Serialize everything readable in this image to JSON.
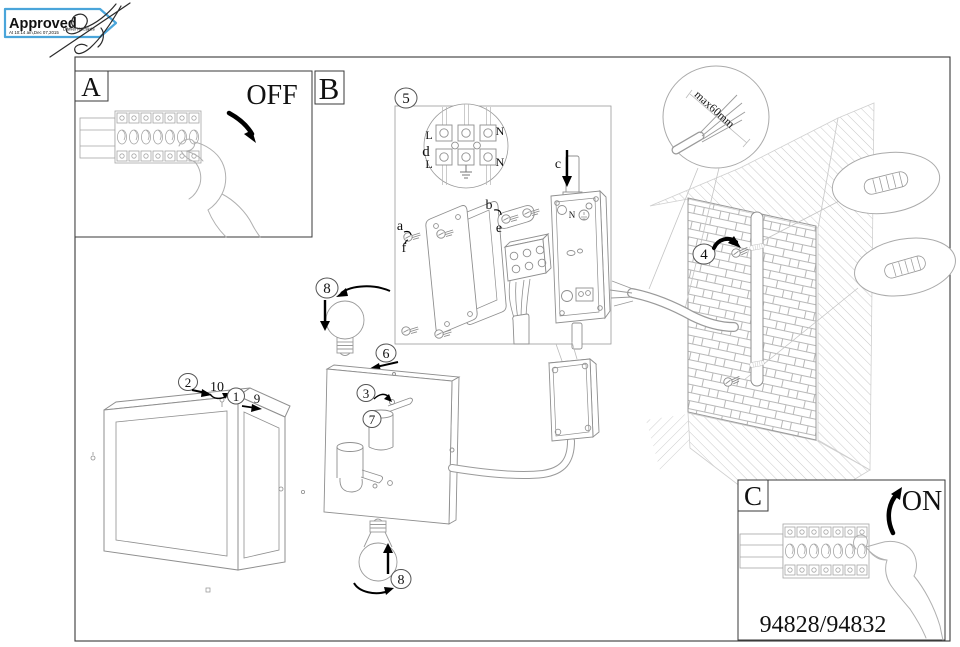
{
  "stamp": {
    "title": "Approved",
    "signer": "Daniel Kecskés",
    "datetime": "At 10:14 am,Dec 07,2015",
    "color": "#2e7fc1"
  },
  "product_code": "94828/94832",
  "panel_a": {
    "letter": "A",
    "state": "OFF"
  },
  "panel_b": {
    "letter": "B"
  },
  "panel_c": {
    "letter": "C",
    "state": "ON"
  },
  "labels": {
    "n1": "1",
    "n2": "2",
    "n3": "3",
    "n4": "4",
    "n5": "5",
    "n6": "6",
    "n7": "7",
    "n8": "8",
    "n9": "9",
    "n10": "10"
  },
  "parts": {
    "a": "a",
    "b": "b",
    "c": "c",
    "e": "e",
    "f": "f"
  },
  "wiring": {
    "l_top": "L",
    "n_top": "N",
    "d": "d",
    "l_bottom": "L",
    "n_bottom": "N"
  },
  "callout": {
    "max_length": "max60mm"
  }
}
